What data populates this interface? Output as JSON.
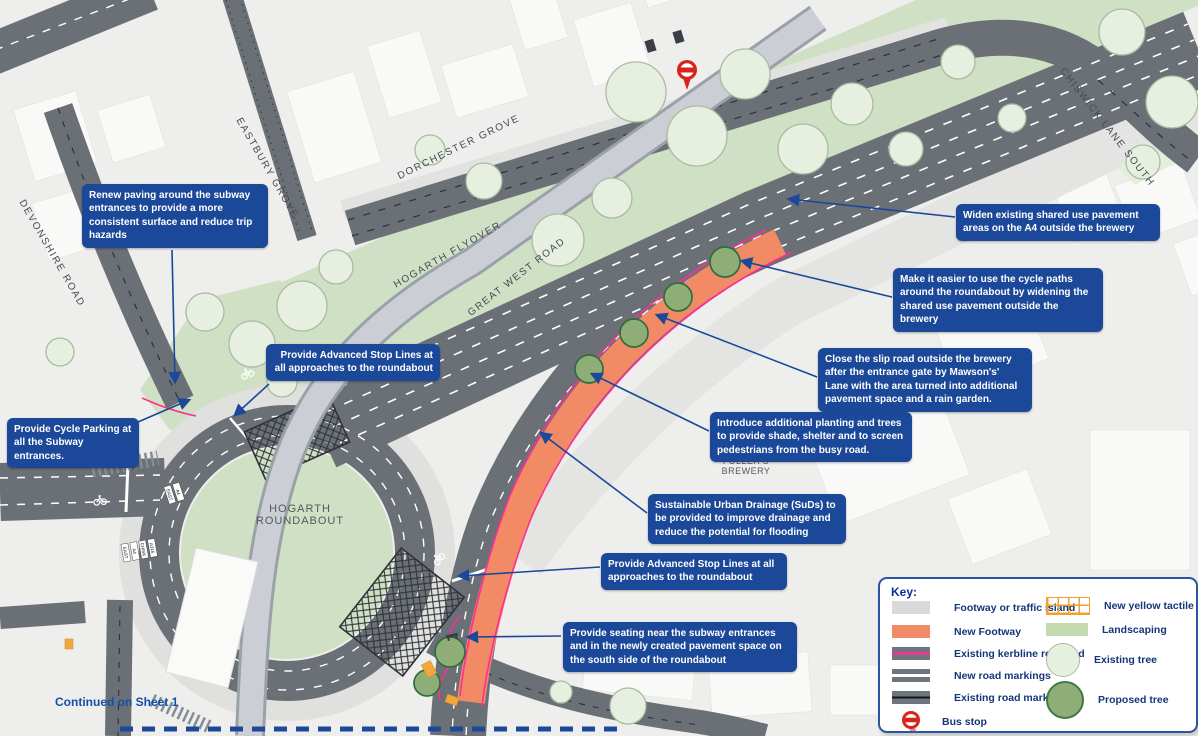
{
  "title": "Hogarth Roundabout improvement scheme plan",
  "colors": {
    "callout_blue": "#1b4898",
    "tfl_blue": "#0d2ea0",
    "road_gray": "#6b7077",
    "flyover_gray": "#cbcfd5",
    "landscaping_green": "#cfe0c5",
    "existing_tree_green": "#e6f0df",
    "proposed_tree_green": "#8fae77",
    "new_footway_salmon": "#f08a67",
    "kerbline_pink": "#ff2d96",
    "tactile_yellow": "#f0a73e",
    "bus_stop_red": "#d6251d"
  },
  "annotations": [
    {
      "id": "renew-paving",
      "text": "Renew paving around the subway entrances to provide a more consistent surface and reduce trip hazards"
    },
    {
      "id": "widen-pavement",
      "text": "Widen existing shared use pavement areas on the A4 outside the brewery"
    },
    {
      "id": "easier-cycle-paths",
      "text": "Make it easier to use the cycle paths around the roundabout by widening the shared use pavement outside the brewery"
    },
    {
      "id": "close-slip-road",
      "text": "Close the slip road outside the brewery after the entrance gate by Mawson's' Lane with the area turned into additional pavement space and a rain garden."
    },
    {
      "id": "additional-planting",
      "text": "Introduce additional planting and trees to provide shade, shelter and to screen pedestrians from the busy road."
    },
    {
      "id": "suds",
      "text": "Sustainable Urban Drainage (SuDs) to be provided to improve drainage and reduce the potential for flooding"
    },
    {
      "id": "asl-south",
      "text": "Provide Advanced Stop Lines at all approaches to the roundabout"
    },
    {
      "id": "seating",
      "text": "Provide seating near the subway entrances and in the newly created pavement space on the south side of the roundabout"
    },
    {
      "id": "asl-north",
      "text": "Provide Advanced Stop Lines at all approaches to the roundabout"
    },
    {
      "id": "cycle-parking",
      "text": "Provide Cycle Parking at all the Subway entrances."
    }
  ],
  "road_labels": {
    "devonshire": "DEVONSHIRE ROAD",
    "eastbury": "EASTBURY GROVE",
    "dorchester": "DORCHESTER GROVE",
    "flyover": "HOGARTH FLYOVER",
    "great_west": "GREAT WEST ROAD",
    "chiswick": "CHISWICK LANE SOUTH"
  },
  "place_labels": {
    "roundabout": "HOGARTH\nROUNDABOUT",
    "brewery": "FULLER'S\nBREWERY"
  },
  "lane_labels": [
    "A316",
    "CHISK",
    "A4",
    "EAST"
  ],
  "notes": {
    "continued": "Continued on Sheet 1"
  },
  "legend": {
    "title": "Key:",
    "left": [
      {
        "swatch": "footway-swatch",
        "label": "Footway or traffic island"
      },
      {
        "swatch": "new-footway-swatch",
        "label": "New Footway"
      },
      {
        "swatch": "kerbline-removed-swatch",
        "label": "Existing kerbline removed"
      },
      {
        "swatch": "new-road-markings-swatch",
        "label": "New road markings"
      },
      {
        "swatch": "existing-road-markings-swatch",
        "label": "Existing road markings"
      },
      {
        "swatch": "bus-stop-icon",
        "label": "Bus stop"
      }
    ],
    "right": [
      {
        "swatch": "new-yellow-tactile-swatch",
        "label": "New yellow tactile"
      },
      {
        "swatch": "landscaping-swatch",
        "label": "Landscaping"
      },
      {
        "swatch": "existing-tree-icon",
        "label": "Existing tree"
      },
      {
        "swatch": "proposed-tree-icon",
        "label": "Proposed tree"
      }
    ]
  }
}
